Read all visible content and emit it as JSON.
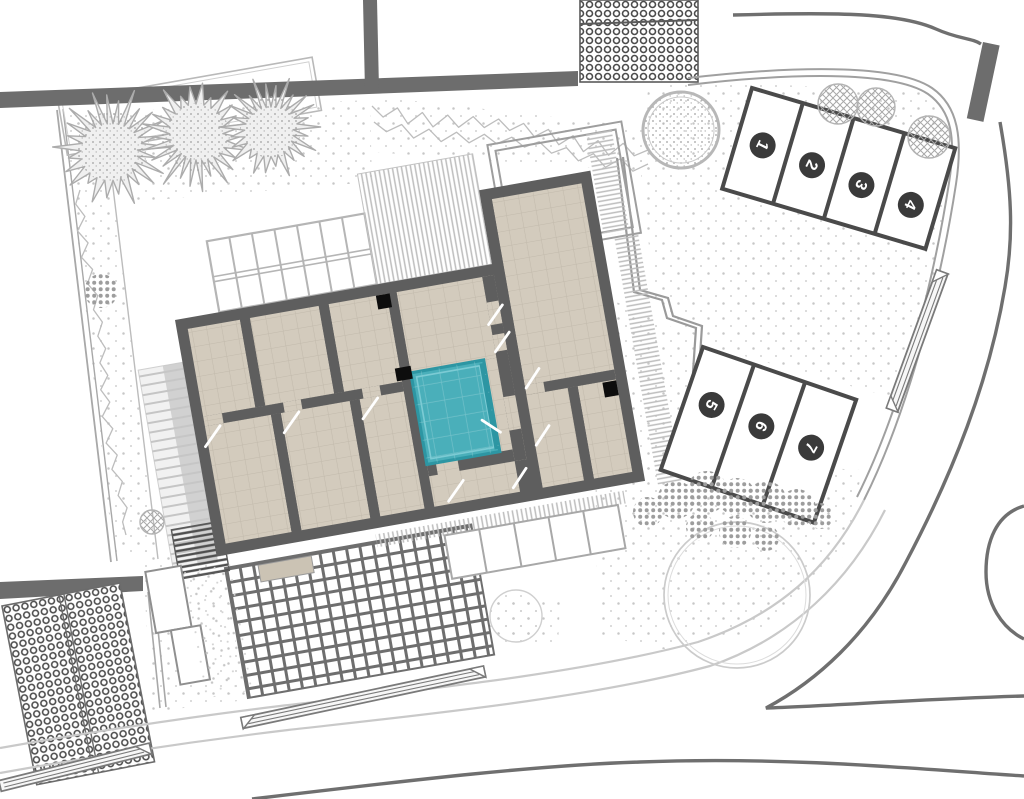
{
  "plan": {
    "kind": "architectural-site-plan",
    "colors": {
      "background": "#ffffff",
      "wall_dark": "#5e5e5e",
      "boundary_wall": "#6d6d6d",
      "floor_tan": "#d3cbbd",
      "floor_grid": "#c2baac",
      "pool_fill": "#4aafba",
      "pool_edge": "#2d96a3",
      "parking_line": "#4a4a4a",
      "badge_fill": "#3a3a3a",
      "badge_text": "#ffffff",
      "path_light": "#c9c9c9",
      "fence_gray": "#a0a0a0",
      "road_dark": "#6f6f6f",
      "vegetation_gray": "#acacac"
    },
    "parking": {
      "upper": {
        "stalls": [
          {
            "number": "1"
          },
          {
            "number": "2"
          },
          {
            "number": "3"
          },
          {
            "number": "4"
          }
        ]
      },
      "lower": {
        "stalls": [
          {
            "number": "5"
          },
          {
            "number": "6"
          },
          {
            "number": "7"
          }
        ]
      }
    }
  }
}
